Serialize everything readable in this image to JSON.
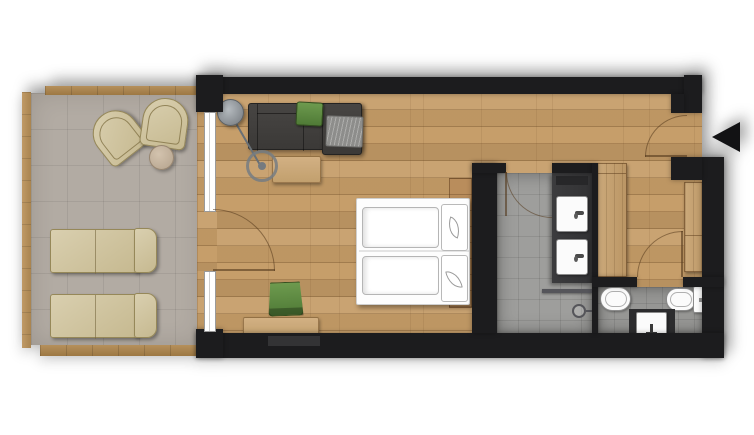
{
  "meta": {
    "type": "floor-plan",
    "view": "top-down",
    "description": "Hotel room floor plan with terrace, living-bedroom, bathroom, hallway and WC"
  },
  "colors": {
    "wall": "#1c1c1e",
    "floorWood": "#c59c67",
    "terraceTile": "#b2aba3",
    "bathTile": "#9e9e9c",
    "wcTile": "#969694",
    "furnitureWood": "#c9a878",
    "headboardWood": "#b98d5c",
    "deckWood": "#aa854f",
    "sofaGray": "#413f3c",
    "accentGreen": "#639044",
    "loungeBeige": "#d2c7a9",
    "fixtureWhite": "#fbfbfb",
    "lampGray": "#9aa0a4",
    "blanketGray": "#8d8d8b"
  },
  "rooms": {
    "terrace": {
      "name": "terrace",
      "floor": "stone-tile",
      "items": [
        "lounge-chair",
        "lounge-chair",
        "side-table",
        "sun-lounger",
        "sun-lounger"
      ]
    },
    "bedroom_living": {
      "name": "bedroom-living",
      "floor": "wood-plank",
      "items": [
        "sofa",
        "green-cushion",
        "blanket",
        "coffee-table",
        "arc-floor-lamp",
        "double-bed",
        "pillow-with-leaf",
        "pillow-with-leaf",
        "headboard-panel",
        "desk",
        "green-chair"
      ]
    },
    "bathroom": {
      "name": "bathroom",
      "floor": "gray-tile",
      "items": [
        "double-vanity",
        "sink",
        "sink",
        "shower-screen",
        "shower-head"
      ]
    },
    "hallway": {
      "name": "hallway",
      "floor": "wood-plank",
      "items": [
        "wardrobe",
        "wardrobe"
      ]
    },
    "wc": {
      "name": "wc",
      "floor": "gray-tile",
      "items": [
        "bidet",
        "toilet",
        "hand-basin"
      ]
    }
  },
  "doors": {
    "entrance": {
      "marker": "arrow-left",
      "swing": "inward"
    },
    "terrace_door": {
      "swing": "inward"
    },
    "bathroom_door": {
      "swing": "inward"
    },
    "wc_door": {
      "swing": "outward"
    }
  },
  "windows": [
    "terrace-window",
    "terrace-window"
  ]
}
